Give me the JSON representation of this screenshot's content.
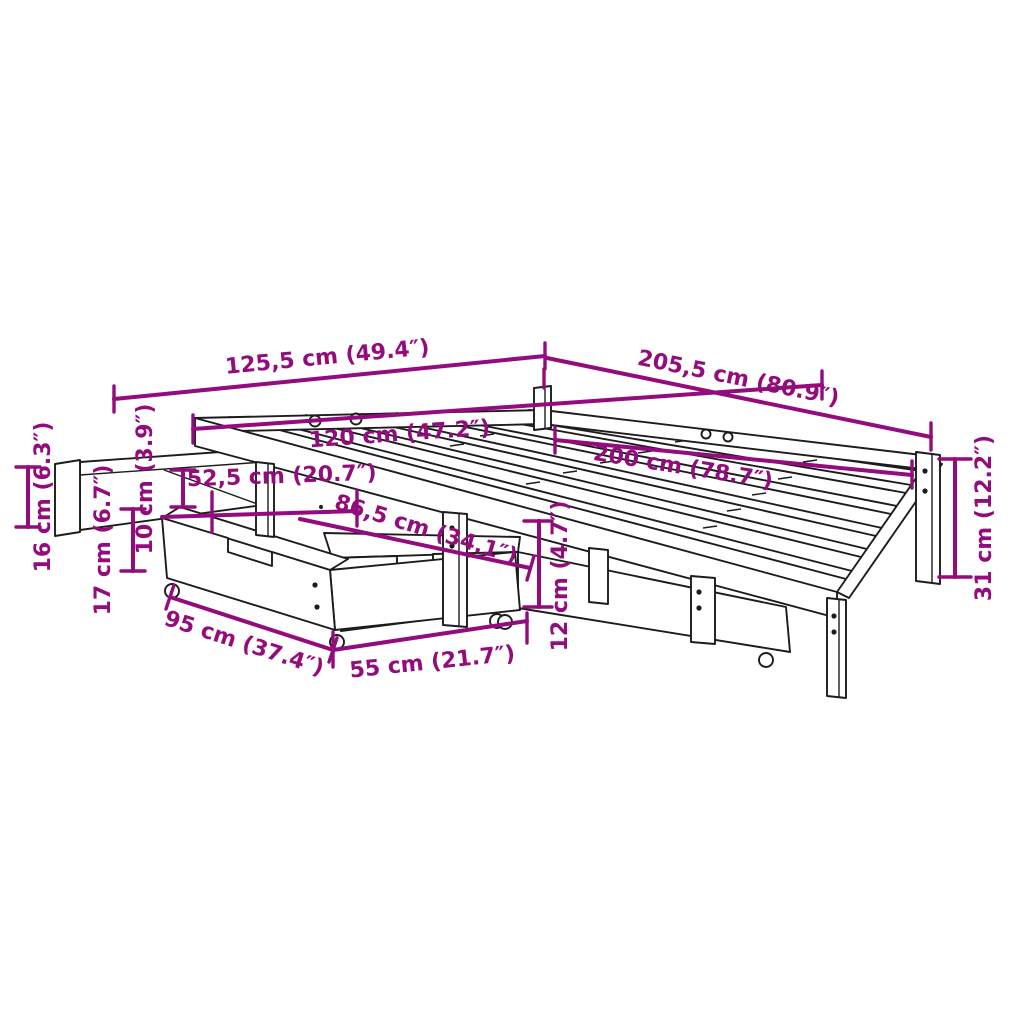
{
  "diagram": {
    "type": "furniture-dimension-diagram",
    "subject": "bed frame with 2 storage drawers and pull-out slat panel",
    "colors": {
      "dimension": "#940b7d",
      "line_art": "#1c1c1c",
      "background": "#ffffff"
    },
    "dimensions": [
      {
        "id": "outer-width",
        "cm": "125,5",
        "inches": "49.4",
        "label": "125,5 cm (49.4″)"
      },
      {
        "id": "outer-length",
        "cm": "205,5",
        "inches": "80.9",
        "label": "205,5 cm (80.9″)"
      },
      {
        "id": "inner-width",
        "cm": "120",
        "inches": "47.2",
        "label": "120 cm (47.2″)"
      },
      {
        "id": "inner-length",
        "cm": "200",
        "inches": "78.7",
        "label": "200 cm (78.7″)"
      },
      {
        "id": "panel-width",
        "cm": "52,5",
        "inches": "20.7",
        "label": "52,5 cm (20.7″)"
      },
      {
        "id": "drawer-diagonal",
        "cm": "86,5",
        "inches": "34.1",
        "label": "86,5 cm (34.1″)"
      },
      {
        "id": "drawer-length",
        "cm": "95",
        "inches": "37.4",
        "label": "95 cm (37.4″)"
      },
      {
        "id": "drawer-depth",
        "cm": "55",
        "inches": "21.7",
        "label": "55 cm (21.7″)"
      },
      {
        "id": "drawer-height",
        "cm": "12",
        "inches": "4.7",
        "label": "12 cm (4.7″)"
      },
      {
        "id": "leg-height",
        "cm": "31",
        "inches": "12.2",
        "label": "31 cm (12.2″)"
      },
      {
        "id": "height-16",
        "cm": "16",
        "inches": "6.3",
        "label": "16 cm (6.3″)"
      },
      {
        "id": "height-17",
        "cm": "17",
        "inches": "6.7",
        "label": "17 cm (6.7″)"
      },
      {
        "id": "height-10",
        "cm": "10",
        "inches": "3.9",
        "label": "10 cm (3.9″)"
      }
    ]
  }
}
